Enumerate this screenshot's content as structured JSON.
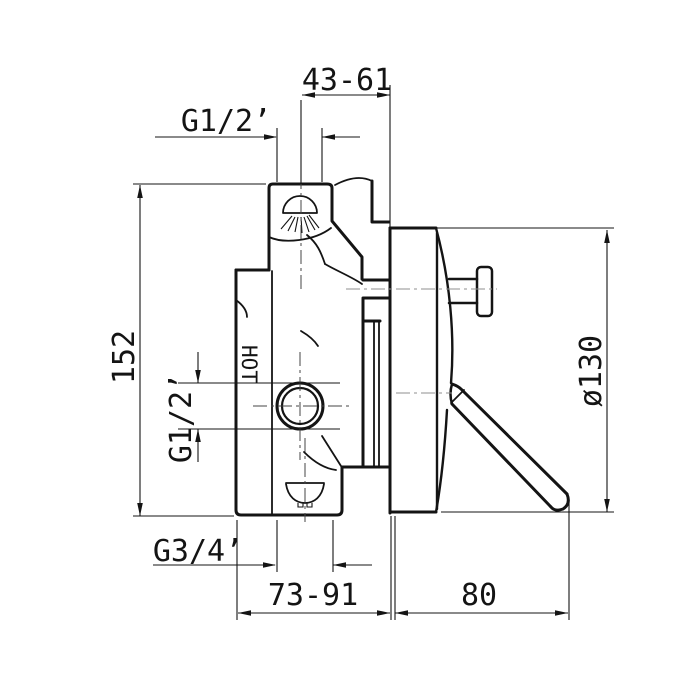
{
  "drawing": {
    "kind": "technical-dimension-drawing",
    "labels": {
      "top_offset": "43-61",
      "top_thread": "G1/2’",
      "height": "152",
      "inlet_thread": "G1/2’",
      "hot": "HOT",
      "plate_diameter": "ø130",
      "bottom_thread": "G3/4’",
      "depth_range": "73-91",
      "projection": "80"
    },
    "colors": {
      "line": "#141414",
      "background": "#ffffff",
      "centerline": "#8f8f8f"
    }
  }
}
